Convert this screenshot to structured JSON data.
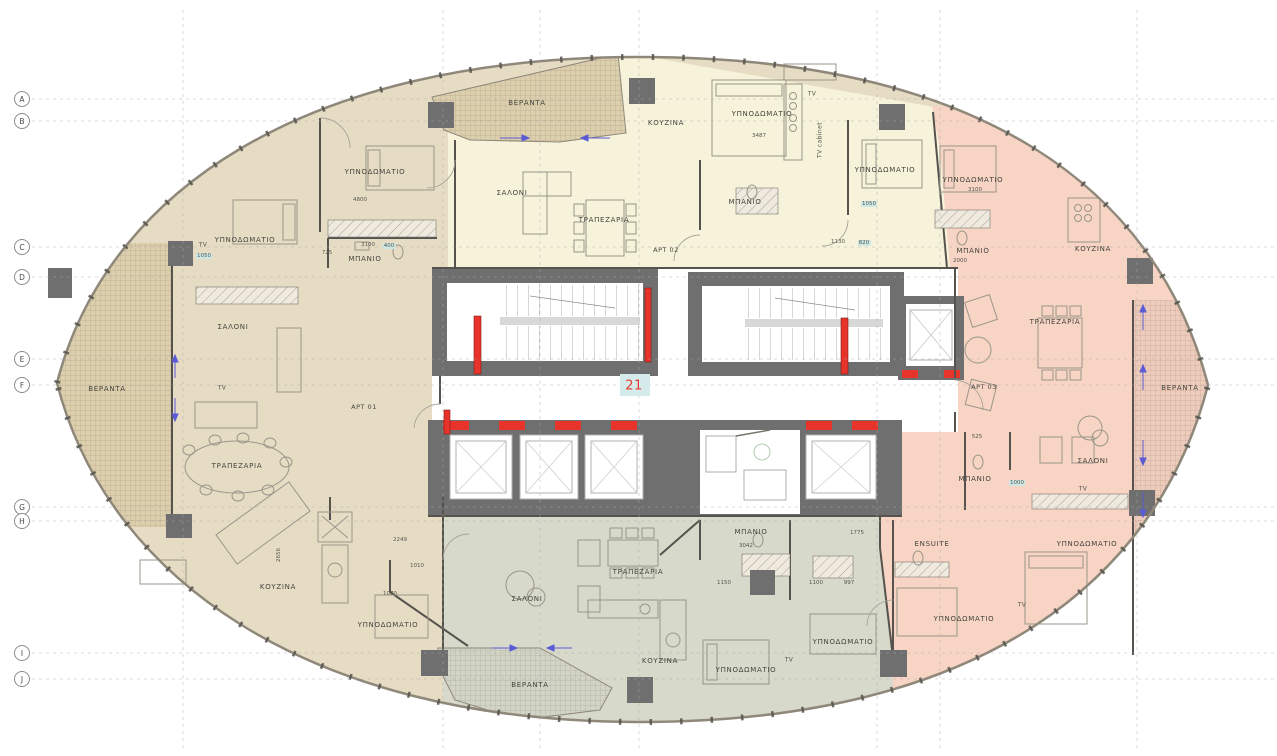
{
  "floor_number": "21",
  "rooms": {
    "bedroom": "ΥΠΝΟΔΩΜΑΤΙΟ",
    "living": "ΣΑΛΟΝΙ",
    "dining": "ΤΡΑΠΕΖΑΡΙΑ",
    "kitchen": "ΚΟΥΖΙΝΑ",
    "bath": "ΜΠΑΝΙΟ",
    "ensuite": "ENSUITE",
    "veranda": "ΒΕΡΑΝΤΑ",
    "tv": "TV",
    "tv_cabinet": "TV cabinet"
  },
  "units": {
    "apt01": "APT 01",
    "apt02": "APT 02",
    "apt03": "APT 03"
  },
  "grid": {
    "rows": [
      "A",
      "B",
      "C",
      "D",
      "E",
      "F",
      "G",
      "H",
      "I",
      "J"
    ]
  },
  "dims": [
    "4800",
    "3487",
    "3100",
    "2000",
    "1130",
    "820",
    "1050",
    "2249",
    "1010",
    "2656",
    "3042",
    "1150",
    "1100",
    "997",
    "1000",
    "1775",
    "725",
    "400",
    "525",
    "1070"
  ],
  "colors": {
    "apartment_left": "#e6dcc4",
    "apartment_top": "#f6f3da",
    "apartment_right": "#f7d4c3",
    "apartment_bottom": "#d7d9cb",
    "core_wall": "#6f6f6f",
    "door_marker_red": "#e8332a",
    "dim_highlight": "#cde8e4",
    "floor_number_red": "#e23b31"
  }
}
